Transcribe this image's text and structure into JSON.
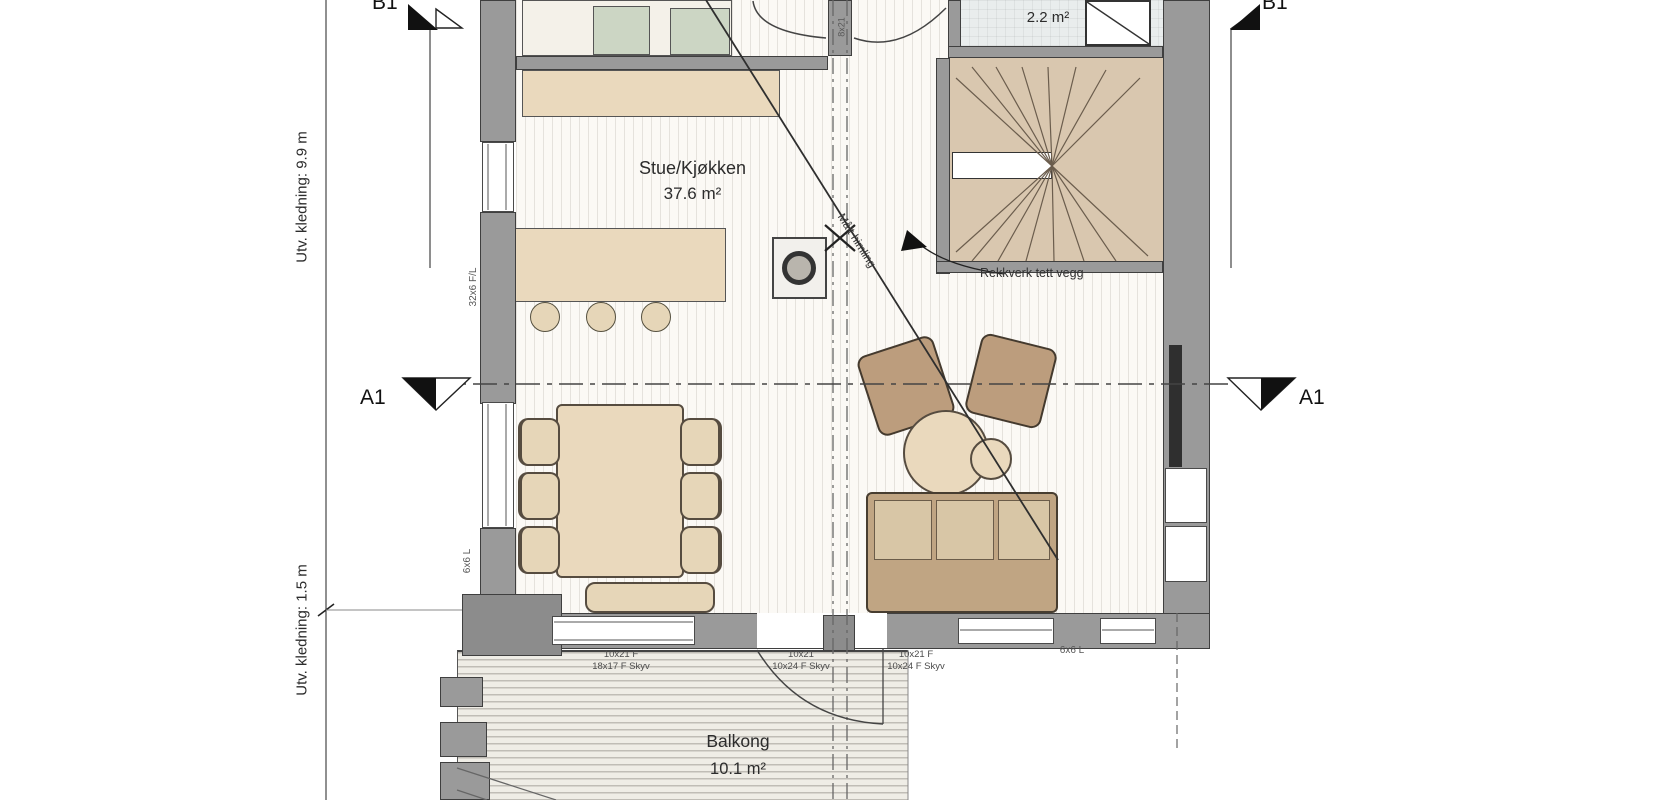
{
  "plan": {
    "rooms": {
      "living_kitchen": {
        "name": "Stue/Kjøkken",
        "area": "37.6 m²"
      },
      "wc": {
        "area": "2.2 m²"
      },
      "balcony": {
        "name": "Balkong",
        "area": "10.1 m²"
      }
    },
    "annotations": {
      "railing_note": "Rekkverk tett vegg",
      "ceiling_note": "Målt himling",
      "wc_door_size": "8x21"
    },
    "dimensions": {
      "facade_upper": "Utv. kledning: 9.9 m",
      "facade_lower": "Utv. kledning: 1.5 m",
      "window_left_upper": "32x6 F/L",
      "window_left_lower": "6x6 L",
      "window_bottom_right": "6x6 L"
    },
    "section_markers": {
      "a": "A1",
      "b": "B1"
    },
    "bottom_windows": [
      {
        "line1": "10x21 F",
        "line2": "18x17 F Skyv"
      },
      {
        "line1": "10x21",
        "line2": "10x24 F Skyv"
      },
      {
        "line1": "10x21 F",
        "line2": "10x24 F Skyv"
      }
    ]
  },
  "colors": {
    "wall": "#9a9a9a",
    "outline": "#3f3f3f",
    "counter": "#ead9bd",
    "chairlight": "#e6d6b8",
    "stair": "#d9c7af",
    "appliance": "#ccd6c4",
    "wcfloor": "#e9eded",
    "sofa": "#c0a583",
    "seat": "#d8c6a6",
    "armchair": "#bc9d7d",
    "deck": "#efede6"
  }
}
